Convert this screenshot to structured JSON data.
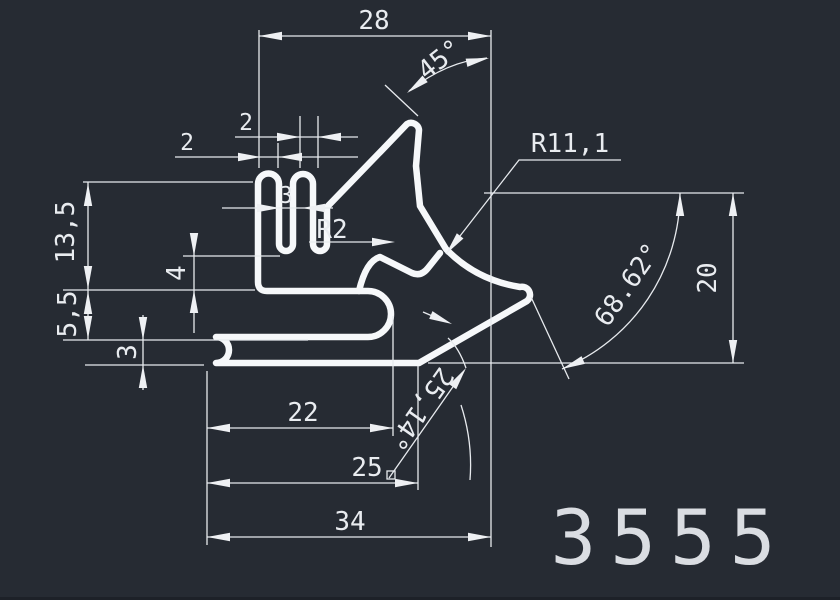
{
  "drawing": {
    "title": "profile-cross-section-drawing",
    "part_number": "3555",
    "background_color": "#262b33",
    "line_color": "#e7eaee",
    "profile_color": "#f6f8fa"
  },
  "labels": {
    "dim_28": "28",
    "dim_45": "45°",
    "dim_r11": "R11,1",
    "dim_20": "20",
    "dim_68": "68.62°",
    "dim_13_5": "13,5",
    "dim_5_5": "5,5",
    "dim_3_left": "3",
    "dim_4": "4",
    "dim_2_a": "2",
    "dim_2_b": "2",
    "dim_3_slot": "3",
    "dim_r2": "R2",
    "dim_22": "22",
    "dim_25": "25",
    "dim_34": "34",
    "dim_25_14": "25,14°"
  }
}
